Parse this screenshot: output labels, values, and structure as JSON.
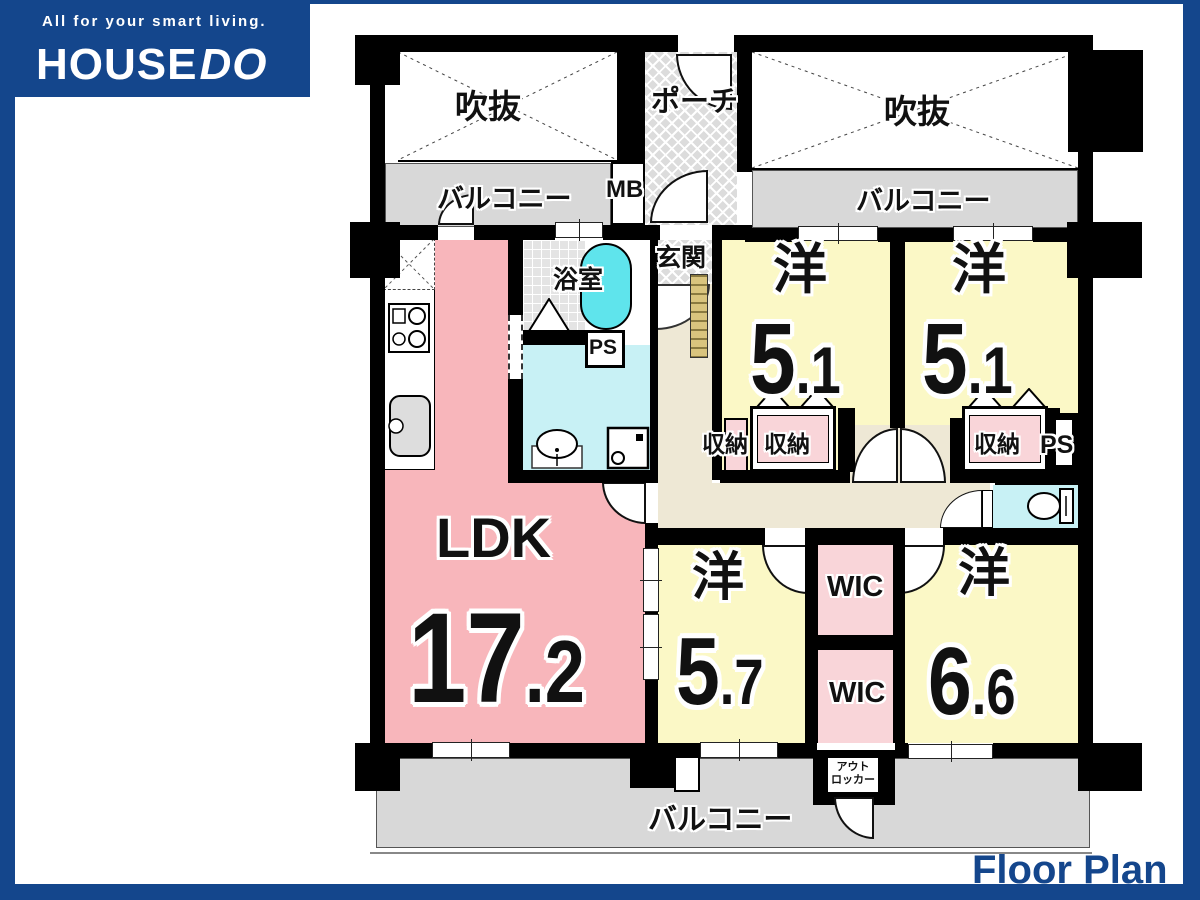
{
  "brand": {
    "tagline": "All for your smart living.",
    "logo_part1": "HOUSE",
    "logo_part2": "DO",
    "footer_label": "Floor Plan",
    "blue": "#14468C"
  },
  "palette": {
    "wall": "#000000",
    "bedroom_yellow": "#FBF8C6",
    "ldk_pink": "#F8B6BB",
    "closet_pink": "#F9D5D9",
    "washroom_cyan": "#C8F1F5",
    "tub_cyan": "#5FE4EC",
    "hall_beige": "#EEE8D5",
    "balcony_gray": "#D8D8D8",
    "porch_gray": "#DCDCDC",
    "cabinet_tan": "#D9C47E"
  },
  "labels": {
    "void_left": "吹抜",
    "void_right": "吹抜",
    "porch": "ポーチ",
    "balcony_top_left": "バルコニー",
    "balcony_top_right": "バルコニー",
    "balcony_bottom": "バルコニー",
    "mb": "MB",
    "bath": "浴室",
    "entrance": "玄関",
    "ps_left": "PS",
    "ps_right": "PS",
    "closet_1a": "収納",
    "closet_1b": "収納",
    "closet_2": "収納",
    "wic_upper": "WIC",
    "wic_lower": "WIC",
    "out_locker_line1": "アウト",
    "out_locker_line2": "ロッカー"
  },
  "rooms": {
    "ldk": {
      "name": "LDK",
      "size_int": "17",
      "size_dec": ".2"
    },
    "bedroom1": {
      "name": "洋",
      "size_int": "5",
      "size_dec": ".1"
    },
    "bedroom2": {
      "name": "洋",
      "size_int": "5",
      "size_dec": ".1"
    },
    "bedroom3": {
      "name": "洋",
      "size_int": "5",
      "size_dec": ".7"
    },
    "bedroom4": {
      "name": "洋",
      "size_int": "6",
      "size_dec": ".6"
    }
  },
  "icons": {
    "stove": "cooktop-2-burner",
    "sink": "kitchen-sink",
    "basin": "wash-basin",
    "washer": "washing-machine",
    "toilet": "toilet",
    "tub": "bathtub"
  }
}
